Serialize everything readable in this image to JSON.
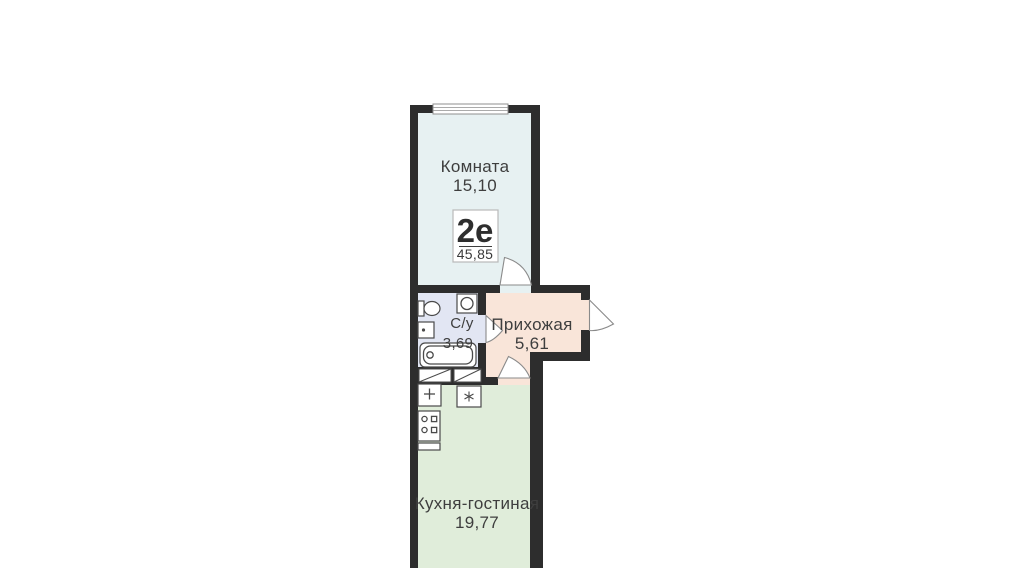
{
  "floorplan": {
    "apartment_badge": {
      "type": "2е",
      "total_area": "45,85"
    },
    "rooms": [
      {
        "name": "Комната",
        "area": "15,10",
        "fill": "#e7f1f2"
      },
      {
        "name": "С/у",
        "area": "3,69",
        "fill": "#e2e6f3"
      },
      {
        "name": "Прихожая",
        "area": "5,61",
        "fill": "#f9e5d9"
      },
      {
        "name": "Кухня-гостиная",
        "area": "19,77",
        "fill": "#e0edda"
      }
    ],
    "colors": {
      "wall": "#2d2d2d",
      "background": "#ffffff",
      "door_stroke": "#8a8a8a",
      "fixture_stroke": "#4a4a4a",
      "text": "#3e3e3e",
      "badge_border": "#b9b9b9"
    },
    "fixtures": [
      "window",
      "ventilation-shaft",
      "toilet",
      "washbasin",
      "washing-machine",
      "bathtub",
      "kitchen-sink",
      "stove",
      "appliance-star"
    ]
  }
}
